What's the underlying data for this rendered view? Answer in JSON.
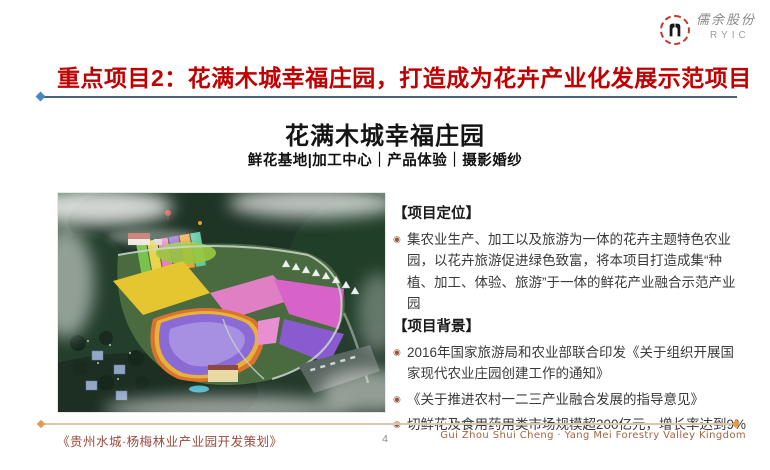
{
  "colors": {
    "title_red": "#c00000",
    "underline": "#46627c",
    "underline_diamond_blue": "#4a86c4",
    "body_text": "#3a3a3a",
    "bullet_icon": "#a0523f",
    "footer_brown": "#9a4a3c",
    "footer_line_tan": "#d9c6ae",
    "footer_diamond_orange": "#e09a52",
    "logo_ring_red": "#c0392b"
  },
  "logo": {
    "company": "儒余股份",
    "abbr": "RYIC"
  },
  "header": {
    "title": "重点项目2：花满木城幸福庄园，打造成为花卉产业化发展示范项目"
  },
  "hero": {
    "title": "花满木城幸福庄园",
    "subtitle": "鲜花基地|加工中心｜产品体验｜摄影婚纱"
  },
  "glyphs": {
    "bullet": "◉"
  },
  "right_panel": {
    "sections": [
      {
        "header": "【项目定位】",
        "bullets": [
          "集农业生产、加工以及旅游为一体的花卉主题特色农业园，以花卉旅游促进绿色致富，将本项目打造成集“种植、加工、体验、旅游”于一体的鲜花产业融合示范产业园"
        ]
      },
      {
        "header": "【项目背景】",
        "bullets": [
          "2016年国家旅游局和农业部联合印发《关于组织开展国家现代农业庄园创建工作的通知》",
          "《关于推进农村一二三产业融合发展的指导意见》",
          "切鲜花及食用药用类市场规模超200亿元，增长率达到9%"
        ]
      }
    ]
  },
  "footer": {
    "left": "《贵州水城·杨梅林业产业园开发策划》",
    "page": "4",
    "right": "Gui Zhou Shui Cheng · Yang Mei Forestry Valley Kingdom"
  }
}
